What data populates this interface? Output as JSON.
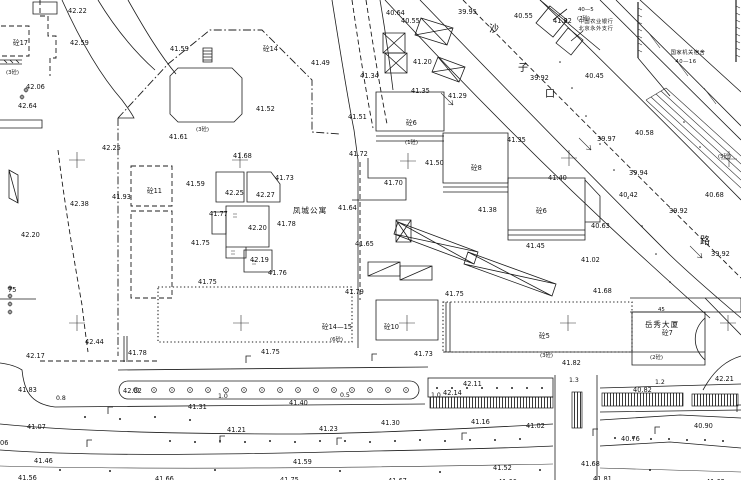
{
  "canvas": {
    "width": 741,
    "height": 480,
    "background": "#ffffff",
    "ink": "#1c1c1c"
  },
  "map": {
    "kind": "cadastral-topographic-survey-sheet",
    "complex_names": [
      {
        "x": 310,
        "y": 207,
        "t": "凤城公寓"
      },
      {
        "x": 662,
        "y": 321,
        "t": "岳秀大厦"
      }
    ],
    "org_text": [
      {
        "x": 596,
        "y": 19,
        "t": "中国农业银行"
      },
      {
        "x": 596,
        "y": 26,
        "t": "北京永外支行"
      },
      {
        "x": 688,
        "y": 50,
        "t": "国家机关宿舍"
      },
      {
        "x": 686,
        "y": 59,
        "t": "40—16"
      }
    ],
    "street_chars": [
      {
        "x": 494,
        "y": 24,
        "t": "沙"
      },
      {
        "x": 523,
        "y": 63,
        "t": "子"
      },
      {
        "x": 550,
        "y": 89,
        "t": "口"
      },
      {
        "x": 705,
        "y": 236,
        "t": "路"
      }
    ],
    "building_labels": [
      [
        13,
        40,
        "砼17"
      ],
      [
        263,
        46,
        "砼14"
      ],
      [
        147,
        188,
        "砼11"
      ],
      [
        406,
        120,
        "砼6"
      ],
      [
        471,
        165,
        "砼8"
      ],
      [
        536,
        208,
        "砼6"
      ],
      [
        322,
        324,
        "砼14—15"
      ],
      [
        384,
        324,
        "砼10"
      ],
      [
        539,
        333,
        "砼5"
      ],
      [
        662,
        330,
        "砼7"
      ]
    ],
    "annotations": [
      [
        6,
        69,
        "(3砼)"
      ],
      [
        196,
        126,
        "(3砼)"
      ],
      [
        405,
        139,
        "(1砼)"
      ],
      [
        718,
        153,
        "(5砼)"
      ],
      [
        330,
        336,
        "(6砼)"
      ],
      [
        540,
        352,
        "(3砼)"
      ],
      [
        650,
        354,
        "(2砼)"
      ],
      [
        577,
        15,
        "(7砼)"
      ],
      [
        578,
        6,
        "40—5"
      ],
      [
        658,
        306,
        "45"
      ]
    ],
    "spot_elevations": [
      [
        68,
        8,
        "42.22"
      ],
      [
        70,
        40,
        "42.59"
      ],
      [
        170,
        46,
        "41.59"
      ],
      [
        26,
        84,
        "42.06"
      ],
      [
        18,
        103,
        "42.64"
      ],
      [
        169,
        134,
        "41.61"
      ],
      [
        102,
        145,
        "42.25"
      ],
      [
        386,
        10,
        "40.64"
      ],
      [
        401,
        18,
        "40.55"
      ],
      [
        458,
        9,
        "39.95"
      ],
      [
        311,
        60,
        "41.49"
      ],
      [
        413,
        59,
        "41.20"
      ],
      [
        360,
        73,
        "41.34"
      ],
      [
        411,
        88,
        "41.35"
      ],
      [
        448,
        93,
        "41.29"
      ],
      [
        256,
        106,
        "41.52"
      ],
      [
        348,
        114,
        "41.51"
      ],
      [
        349,
        151,
        "41.72"
      ],
      [
        425,
        160,
        "41.50"
      ],
      [
        514,
        13,
        "40.55"
      ],
      [
        553,
        18,
        "41.82"
      ],
      [
        530,
        75,
        "39.92"
      ],
      [
        585,
        73,
        "40.45"
      ],
      [
        597,
        136,
        "39.97"
      ],
      [
        635,
        130,
        "40.58"
      ],
      [
        507,
        137,
        "41.35"
      ],
      [
        233,
        153,
        "41.68"
      ],
      [
        275,
        175,
        "41.73"
      ],
      [
        186,
        181,
        "41.59"
      ],
      [
        225,
        190,
        "42.25"
      ],
      [
        256,
        192,
        "42.27"
      ],
      [
        209,
        211,
        "41.77"
      ],
      [
        248,
        225,
        "42.20"
      ],
      [
        277,
        221,
        "41.78"
      ],
      [
        191,
        240,
        "41.75"
      ],
      [
        250,
        257,
        "42.19"
      ],
      [
        268,
        270,
        "41.76"
      ],
      [
        198,
        279,
        "41.75"
      ],
      [
        112,
        194,
        "41.93"
      ],
      [
        70,
        201,
        "42.38"
      ],
      [
        21,
        232,
        "42.20"
      ],
      [
        384,
        180,
        "41.70"
      ],
      [
        338,
        205,
        "41.64"
      ],
      [
        355,
        241,
        "41.65"
      ],
      [
        478,
        207,
        "41.38"
      ],
      [
        526,
        243,
        "41.45"
      ],
      [
        548,
        175,
        "41.40"
      ],
      [
        629,
        170,
        "39.94"
      ],
      [
        619,
        192,
        "40.42"
      ],
      [
        669,
        208,
        "39.92"
      ],
      [
        591,
        223,
        "40.63"
      ],
      [
        705,
        192,
        "40.68"
      ],
      [
        711,
        251,
        "39.92"
      ],
      [
        581,
        257,
        "41.02"
      ],
      [
        593,
        288,
        "41.68"
      ],
      [
        345,
        289,
        "41.79"
      ],
      [
        445,
        291,
        "41.75"
      ],
      [
        85,
        339,
        "42.44"
      ],
      [
        26,
        353,
        "42.17"
      ],
      [
        128,
        350,
        "41.78"
      ],
      [
        261,
        349,
        "41.75"
      ],
      [
        414,
        351,
        "41.73"
      ],
      [
        562,
        360,
        "41.82"
      ],
      [
        18,
        387,
        "41.83"
      ],
      [
        123,
        388,
        "42.02"
      ],
      [
        463,
        381,
        "42.11"
      ],
      [
        443,
        390,
        "42.14"
      ],
      [
        633,
        387,
        "40.82"
      ],
      [
        715,
        376,
        "42.21"
      ],
      [
        188,
        404,
        "41.31"
      ],
      [
        289,
        400,
        "41.40"
      ],
      [
        381,
        420,
        "41.30"
      ],
      [
        471,
        419,
        "41.16"
      ],
      [
        526,
        423,
        "41.02"
      ],
      [
        621,
        436,
        "40.76"
      ],
      [
        694,
        423,
        "40.90"
      ],
      [
        27,
        424,
        "41.07"
      ],
      [
        227,
        427,
        "41.21"
      ],
      [
        319,
        426,
        "41.23"
      ],
      [
        34,
        458,
        "41.46"
      ],
      [
        293,
        459,
        "41.59"
      ],
      [
        493,
        465,
        "41.52"
      ],
      [
        581,
        461,
        "41.68"
      ],
      [
        18,
        475,
        "41.56"
      ],
      [
        155,
        476,
        "41.66"
      ],
      [
        280,
        477,
        "41.75"
      ],
      [
        388,
        478,
        "41.67"
      ],
      [
        498,
        479,
        "41.66"
      ],
      [
        593,
        476,
        "41.81"
      ],
      [
        706,
        479,
        "41.62"
      ],
      [
        8,
        287,
        "75"
      ],
      [
        0,
        440,
        "06"
      ]
    ],
    "width_marks": [
      [
        56,
        395,
        "0.8"
      ],
      [
        218,
        393,
        "1.0"
      ],
      [
        340,
        392,
        "0.5"
      ],
      [
        431,
        392,
        "1.0"
      ],
      [
        569,
        377,
        "1.3"
      ],
      [
        655,
        379,
        "1.2"
      ]
    ],
    "grid_crosses": [
      [
        77,
        160
      ],
      [
        240,
        160
      ],
      [
        408,
        161
      ],
      [
        569,
        158
      ],
      [
        729,
        159
      ],
      [
        77,
        323
      ],
      [
        241,
        323
      ],
      [
        407,
        323
      ],
      [
        568,
        323
      ],
      [
        728,
        323
      ]
    ],
    "trees_median": [
      [
        136,
        390
      ],
      [
        154,
        390
      ],
      [
        172,
        390
      ],
      [
        190,
        390
      ],
      [
        208,
        390
      ],
      [
        226,
        390
      ],
      [
        244,
        390
      ],
      [
        262,
        390
      ],
      [
        280,
        390
      ],
      [
        298,
        390
      ],
      [
        316,
        390
      ],
      [
        334,
        390
      ],
      [
        352,
        390
      ],
      [
        370,
        390
      ],
      [
        388,
        390
      ],
      [
        406,
        390
      ]
    ],
    "dots_bay": [
      [
        437,
        388
      ],
      [
        452,
        388
      ],
      [
        467,
        388
      ],
      [
        482,
        388
      ],
      [
        497,
        388
      ],
      [
        512,
        388
      ],
      [
        527,
        388
      ],
      [
        542,
        388
      ]
    ],
    "dots_road2": [
      [
        170,
        441
      ],
      [
        195,
        442
      ],
      [
        220,
        441
      ],
      [
        245,
        442
      ],
      [
        270,
        441
      ],
      [
        295,
        442
      ],
      [
        320,
        441
      ],
      [
        345,
        441
      ],
      [
        370,
        442
      ],
      [
        395,
        441
      ],
      [
        420,
        440
      ],
      [
        445,
        441
      ],
      [
        470,
        440
      ],
      [
        495,
        440
      ],
      [
        520,
        439
      ]
    ],
    "dots_east": [
      [
        615,
        438
      ],
      [
        633,
        438
      ],
      [
        651,
        439
      ],
      [
        669,
        439
      ],
      [
        687,
        440
      ],
      [
        705,
        440
      ],
      [
        723,
        441
      ]
    ],
    "dots_left": [
      [
        85,
        417
      ],
      [
        120,
        419
      ],
      [
        155,
        417
      ],
      [
        190,
        420
      ]
    ],
    "dots_bottom": [
      [
        60,
        470
      ],
      [
        110,
        471
      ],
      [
        215,
        470
      ],
      [
        340,
        471
      ],
      [
        440,
        472
      ],
      [
        540,
        470
      ],
      [
        650,
        470
      ]
    ],
    "dots_street": [
      [
        560,
        62
      ],
      [
        572,
        88
      ],
      [
        586,
        116
      ],
      [
        600,
        144
      ],
      [
        614,
        170
      ],
      [
        628,
        198
      ],
      [
        642,
        226
      ],
      [
        656,
        254
      ],
      [
        670,
        282
      ],
      [
        684,
        122
      ],
      [
        700,
        147
      ]
    ],
    "shrubs": [
      [
        10,
        288
      ],
      [
        10,
        296
      ],
      [
        10,
        304
      ],
      [
        10,
        312
      ],
      [
        26,
        90
      ],
      [
        22,
        97
      ]
    ],
    "lamps": [
      [
        108,
        414
      ],
      [
        87,
        447
      ],
      [
        220,
        443
      ],
      [
        337,
        445
      ],
      [
        462,
        440
      ],
      [
        593,
        436
      ],
      [
        655,
        434
      ],
      [
        737,
        412
      ],
      [
        246,
        363
      ],
      [
        372,
        361
      ]
    ],
    "slope_arrows": [
      [
        447,
        99
      ],
      [
        585,
        144
      ],
      [
        696,
        252
      ]
    ]
  }
}
